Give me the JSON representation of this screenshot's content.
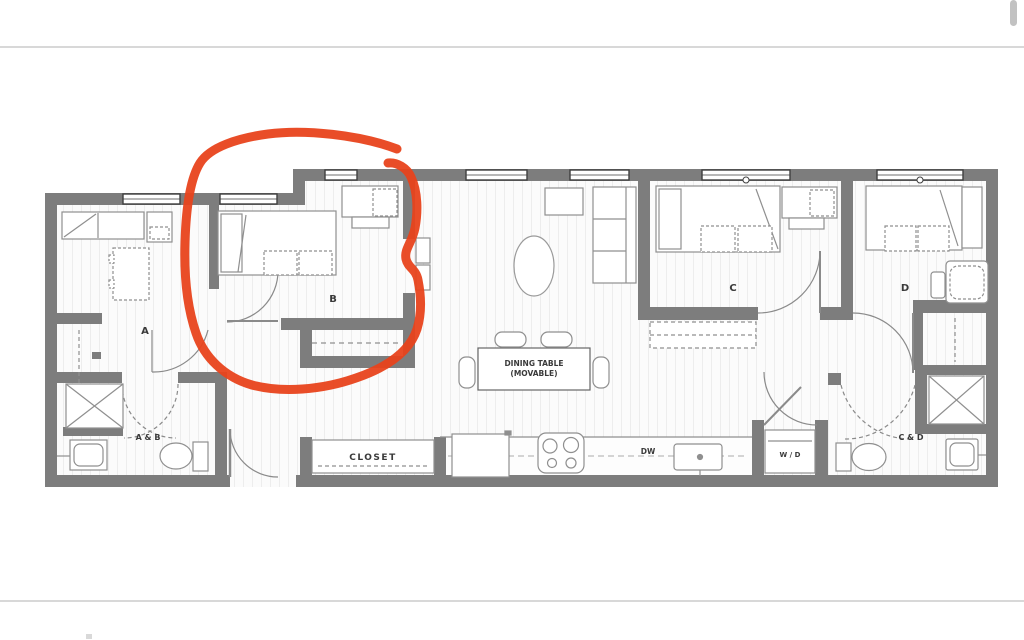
{
  "page": {
    "background": "#ffffff",
    "divider_color": "#d8d8d8",
    "scrollbar_color": "#c2c2c2"
  },
  "floorplan": {
    "wall_color": "#7d7d7d",
    "furniture_line_color": "#8f8f8f",
    "label_color": "#3a3a3a",
    "floor_color": "#fbfbfb",
    "rooms": {
      "a": "A",
      "b": "B",
      "c": "C",
      "d": "D"
    },
    "bathrooms": {
      "ab": "A & B",
      "cd": "C & D"
    },
    "labels": {
      "closet": "CLOSET",
      "dishwasher": "DW",
      "washer_dryer": "W / D",
      "dining_table_line1": "DINING TABLE",
      "dining_table_line2": "(MOVABLE)"
    }
  },
  "annotation": {
    "shape": "freehand circle",
    "color": "#e8431c",
    "highlights": "bedroom B"
  }
}
